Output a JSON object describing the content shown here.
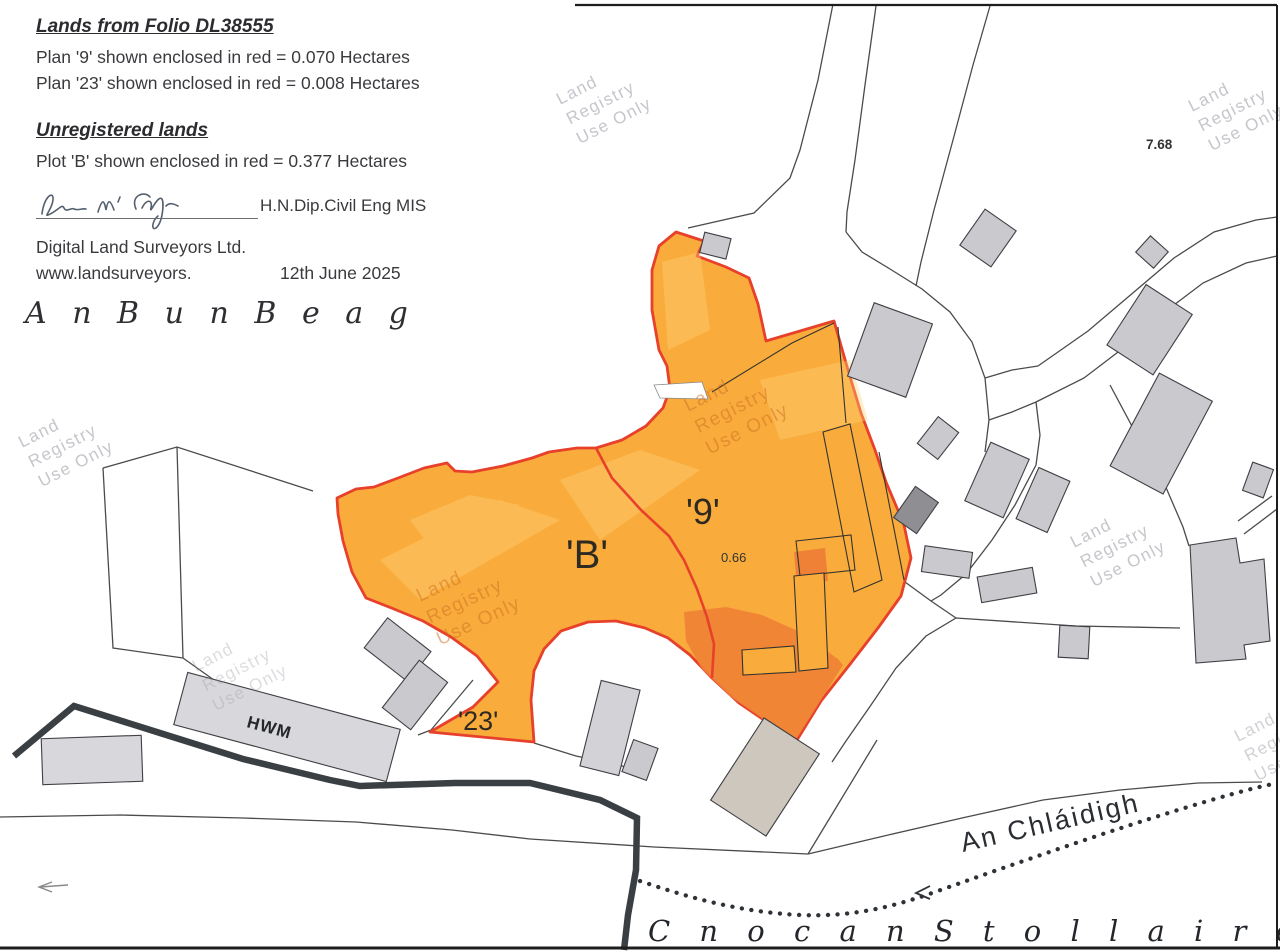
{
  "legend": {
    "folio_title": "Lands from Folio DL38555",
    "plan9_line": "Plan '9' shown enclosed in red = 0.070 Hectares",
    "plan23_line": "Plan '23' shown enclosed in red = 0.008 Hectares",
    "unregistered_title": "Unregistered lands",
    "plotB_line": "Plot 'B' shown enclosed in red = 0.377 Hectares",
    "credentials": "H.N.Dip.Civil Eng MIS",
    "company": "Digital Land Surveyors Ltd.",
    "website": "www.landsurveyors.",
    "date": "12th June 2025"
  },
  "map": {
    "placenames": {
      "townland_top": "A n      B u n      B e a g",
      "river": "An Chláidigh",
      "townland_bottom": "C n o c   a n   S t o l l a i r e"
    },
    "labels": {
      "plot_b": "'B'",
      "plot_9": "'9'",
      "plot_23": "'23'",
      "area_066": "0.66",
      "area_768": "7.68",
      "hwm": "HWM"
    },
    "watermark": {
      "line1": "Land",
      "line2": "Registry",
      "line3": "Use Only"
    },
    "colors": {
      "plot_fill": "#F9AC3B",
      "plot_fill_dark": "#EF8136",
      "plot_outline": "#E7402B",
      "building_fill": "#C9C9CE",
      "thin_line": "#4B4B4B",
      "hwm_line": "#3A3F44"
    }
  }
}
